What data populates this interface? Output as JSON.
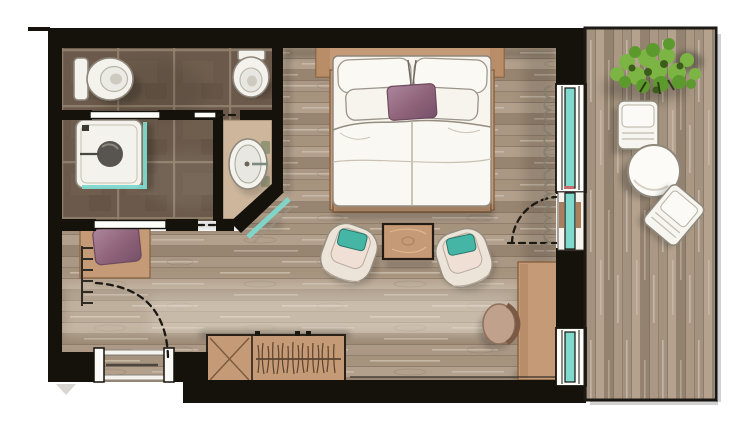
{
  "plan": {
    "kind": "hotel-room-floor-plan-top-view",
    "rooms": {
      "bathroom": {
        "floor": "dark-brown-tile",
        "fixtures": [
          "toilet-with-tank",
          "wall-hung-toilet",
          "shower-with-glass-screen",
          "vanity-sink",
          "sliding-door",
          "sliding-door-lower",
          "glass-corner-panel"
        ]
      },
      "bedroom": {
        "floor": "wood-plank-horizontal",
        "furniture": [
          "headboard",
          "double-bed",
          "pillows",
          "accent-pillow-mauve",
          "armchair-left",
          "armchair-right",
          "coffee-table",
          "desk",
          "desk-chair",
          "wardrobe-with-hangers",
          "luggage-bench-x",
          "bench-with-mauve-pillow",
          "wall-radiator-hooks",
          "entry-door-swing",
          "balcony-door-swing",
          "curtain"
        ]
      },
      "balcony": {
        "floor": "wood-plank-vertical",
        "furniture": [
          "potted-plant",
          "balcony-chair-top",
          "round-table",
          "balcony-chair-bottom"
        ]
      }
    },
    "openings": [
      "entry-door",
      "bathroom-sliding-doors",
      "balcony-glazed-door",
      "window-upper",
      "window-lower"
    ]
  },
  "palette": {
    "paper": "#ffffff",
    "wall": "#15110b",
    "tan": "#c59a76",
    "tan-dark": "#8a6544",
    "glass": "#7fd9cd",
    "teal": "#45b5a6",
    "mauve": "#8f6379",
    "mauve-dark": "#6e4a5d",
    "bed-white": "#f8f5ef",
    "fixture-white": "#f4f2ed",
    "outline": "#8d867b",
    "plant-1": "#7cb544",
    "plant-2": "#5d9a2e",
    "plant-3": "#3c5c1c",
    "tile": "#6b5a4b",
    "grout": "#93816c",
    "wood-base": "#a6937e",
    "balcony-wood": "#a3927f"
  }
}
